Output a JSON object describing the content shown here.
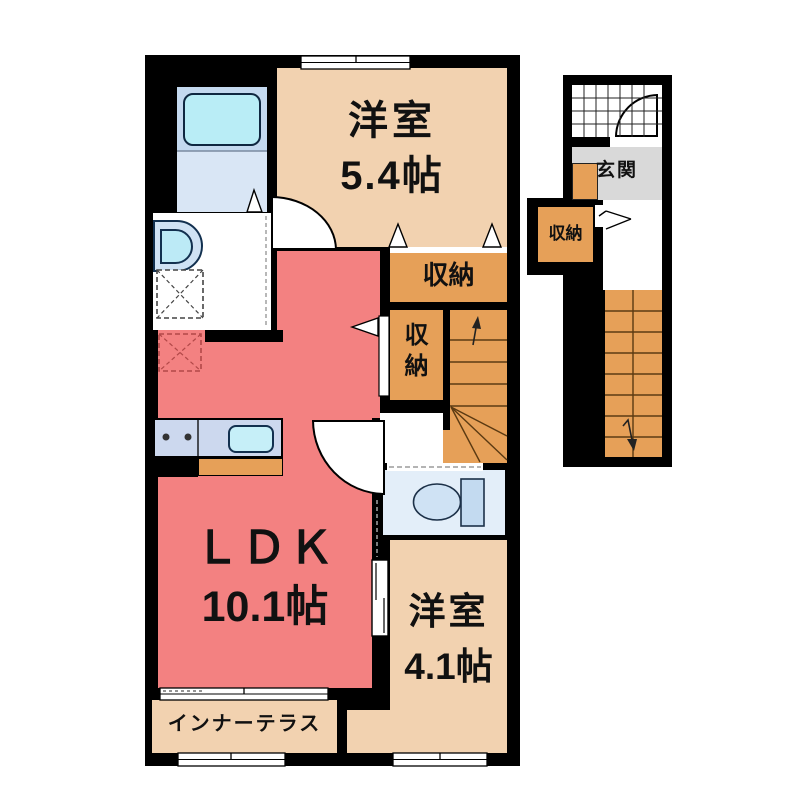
{
  "plan": {
    "title": "apartment-floor-plan",
    "unit": {
      "rooms": {
        "western_upper": {
          "name": "洋室",
          "size": "5.4帖"
        },
        "ldk": {
          "name": "ＬＤＫ",
          "size": "10.1帖"
        },
        "western_lower": {
          "name": "洋室",
          "size": "4.1帖"
        },
        "closet_upper": {
          "name": "収納"
        },
        "closet_side": {
          "name": "収納"
        },
        "inner_terrace": {
          "name": "インナーテラス"
        }
      },
      "fixtures": [
        "bathtub",
        "washbasin",
        "washing-machine-pan",
        "refrigerator-space",
        "kitchen-counter",
        "kitchen-sink",
        "gas-burners",
        "toilet",
        "staircase-with-winders",
        "hinged-door-arcs",
        "bifold-door-triangles",
        "sliding-door",
        "windows"
      ]
    },
    "annex": {
      "rooms": {
        "entrance": {
          "name": "玄関"
        },
        "closet": {
          "name": "収納"
        }
      },
      "fixtures": [
        "porch-tile-grid",
        "entrance-door-arc",
        "straight-staircase",
        "direction-arrow",
        "step-board"
      ]
    },
    "colors": {
      "wall": "#000000",
      "western_room": "#f2d2b0",
      "ldk": "#f38181",
      "closet": "#e6a058",
      "entrance": "#d9d9d9",
      "bathroom": "#d9e6f5",
      "fixture_blue": "#cfe3f4",
      "fixture_cyan": "#b9edf6",
      "stair_line": "#5b3a12"
    }
  }
}
